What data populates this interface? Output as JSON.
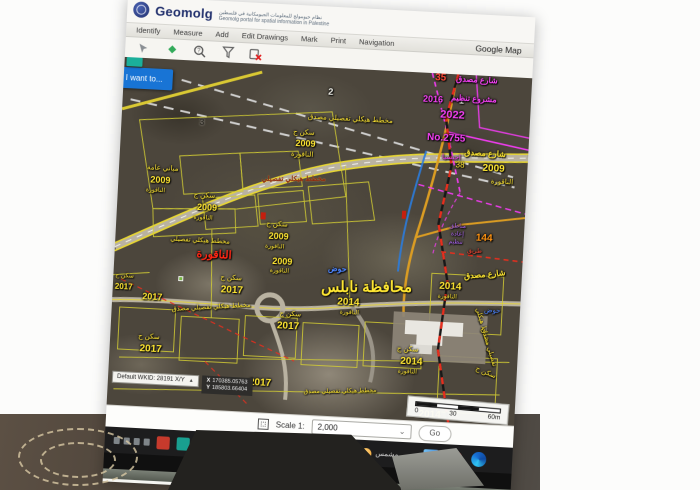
{
  "app": {
    "title": "Geomolg",
    "subtitle_ar": "نظام جيومولج للمعلومات الجيومكانية في فلسطين",
    "subtitle_en": "Geomolg portal for spatial information in Palestine"
  },
  "menu": {
    "items": [
      {
        "id": "identify",
        "label": "Identify"
      },
      {
        "id": "measure",
        "label": "Measure"
      },
      {
        "id": "add",
        "label": "Add"
      },
      {
        "id": "edit-drawings",
        "label": "Edit Drawings"
      },
      {
        "id": "mark",
        "label": "Mark"
      },
      {
        "id": "print",
        "label": "Print"
      },
      {
        "id": "navigation",
        "label": "Navigation"
      },
      {
        "id": "google-map",
        "label": "Google Map",
        "push": true
      }
    ]
  },
  "toolbar": {
    "icons": [
      "pointer-icon",
      "measure-area-icon",
      "identify-question-icon",
      "filter-funnel-icon",
      "clear-graphics-icon"
    ]
  },
  "map": {
    "i_want_to": "I want to...",
    "labels": [
      {
        "t": "2",
        "x": 205,
        "y": 20,
        "c": "wh",
        "s": 9,
        "b": 1
      },
      {
        "t": "1",
        "x": 336,
        "y": 22,
        "c": "wh",
        "s": 9,
        "b": 1
      },
      {
        "t": "3",
        "x": 78,
        "y": 57,
        "c": "dk",
        "s": 9,
        "b": 1
      },
      {
        "t": "35",
        "x": 311,
        "y": 0,
        "c": "rd",
        "s": 10,
        "b": 1
      },
      {
        "t": "شارع مصدق",
        "x": 332,
        "y": 1,
        "c": "m",
        "s": 8,
        "b": 1
      },
      {
        "t": "2016",
        "x": 300,
        "y": 22,
        "c": "m",
        "s": 9,
        "b": 1
      },
      {
        "t": "مشروع تنظيم",
        "x": 328,
        "y": 20,
        "c": "m",
        "s": 8,
        "b": 1
      },
      {
        "t": "2022",
        "x": 318,
        "y": 36,
        "c": "m",
        "s": 11,
        "b": 1
      },
      {
        "t": "No.2755",
        "x": 306,
        "y": 60,
        "c": "m",
        "s": 10,
        "b": 1
      },
      {
        "t": "اجنسيا",
        "x": 322,
        "y": 80,
        "c": "m",
        "s": 7
      },
      {
        "t": "شارع مصدق",
        "x": 344,
        "y": 74,
        "c": "y",
        "s": 8,
        "b": 1
      },
      {
        "t": "38",
        "x": 336,
        "y": 87,
        "c": "y",
        "s": 8
      },
      {
        "t": "2009",
        "x": 363,
        "y": 88,
        "c": "y",
        "s": 10,
        "b": 1
      },
      {
        "t": "الناقورة",
        "x": 372,
        "y": 102,
        "c": "y",
        "s": 7
      },
      {
        "t": "مخطط هيكلي تفصيلي مصدق",
        "x": 186,
        "y": 47,
        "c": "y",
        "s": 7
      },
      {
        "t": "سكن ج",
        "x": 172,
        "y": 63,
        "c": "y",
        "s": 7
      },
      {
        "t": "2009",
        "x": 175,
        "y": 73,
        "c": "y",
        "s": 9,
        "b": 1
      },
      {
        "t": "الناقورة",
        "x": 171,
        "y": 85,
        "c": "y",
        "s": 7
      },
      {
        "t": "مخطط هيكلي تفصيلي",
        "x": 143,
        "y": 110,
        "c": "dr",
        "s": 7,
        "r": -3,
        "b": 1
      },
      {
        "t": "مباني عامة",
        "x": 28,
        "y": 106,
        "c": "y",
        "s": 7
      },
      {
        "t": "2009",
        "x": 32,
        "y": 117,
        "c": "y",
        "s": 9,
        "b": 1
      },
      {
        "t": "الناقورة",
        "x": 28,
        "y": 129,
        "c": "y",
        "s": 6
      },
      {
        "t": "سكن ج",
        "x": 76,
        "y": 131,
        "c": "y",
        "s": 7
      },
      {
        "t": "2009",
        "x": 80,
        "y": 142,
        "c": "y",
        "s": 9,
        "b": 1
      },
      {
        "t": "الناقورة",
        "x": 77,
        "y": 154,
        "c": "y",
        "s": 6
      },
      {
        "t": "مخطط هيكلي تفصيلي",
        "x": 55,
        "y": 177,
        "c": "y",
        "s": 6.5
      },
      {
        "t": "الناقورة",
        "x": 82,
        "y": 188,
        "c": "rd2",
        "s": 11,
        "b": 1
      },
      {
        "t": "سكن ج",
        "x": 150,
        "y": 156,
        "c": "y",
        "s": 7
      },
      {
        "t": "2009",
        "x": 153,
        "y": 167,
        "c": "y",
        "s": 9,
        "b": 1
      },
      {
        "t": "الناقورة",
        "x": 150,
        "y": 179,
        "c": "y",
        "s": 6
      },
      {
        "t": "2009",
        "x": 158,
        "y": 192,
        "c": "y",
        "s": 9,
        "b": 1
      },
      {
        "t": "الناقورة",
        "x": 156,
        "y": 203,
        "c": "y",
        "s": 6
      },
      {
        "t": "مخطط هيكلي تفصيلي مصدق",
        "x": 60,
        "y": 243,
        "c": "y",
        "s": 6.5,
        "r": -6
      },
      {
        "t": "سكن ج",
        "x": 107,
        "y": 212,
        "c": "y",
        "s": 7
      },
      {
        "t": "2017",
        "x": 108,
        "y": 223,
        "c": "y",
        "s": 10,
        "b": 1
      },
      {
        "t": "2017",
        "x": 30,
        "y": 234,
        "c": "y",
        "s": 9,
        "b": 1
      },
      {
        "t": "سكن ج",
        "x": 2,
        "y": 216,
        "c": "y",
        "s": 6
      },
      {
        "t": "2017",
        "x": 2,
        "y": 226,
        "c": "y",
        "s": 8,
        "b": 1
      },
      {
        "t": "سكن ج",
        "x": 168,
        "y": 245,
        "c": "y",
        "s": 7
      },
      {
        "t": "2017",
        "x": 166,
        "y": 256,
        "c": "y",
        "s": 10,
        "b": 1
      },
      {
        "t": "سكن ج",
        "x": 28,
        "y": 275,
        "c": "y",
        "s": 7
      },
      {
        "t": "2017",
        "x": 30,
        "y": 286,
        "c": "y",
        "s": 10,
        "b": 1
      },
      {
        "t": "2017",
        "x": 141,
        "y": 314,
        "c": "y",
        "s": 10,
        "b": 1
      },
      {
        "t": "مخطط هيكلي تفصيلي مصدق",
        "x": 196,
        "y": 320,
        "c": "y",
        "s": 6,
        "r": -4
      },
      {
        "t": "حوض",
        "x": 214,
        "y": 197,
        "c": "bl",
        "s": 8,
        "b": 1
      },
      {
        "t": "محافظة نابلس",
        "x": 208,
        "y": 210,
        "c": "y",
        "s": 15,
        "b": 1,
        "r": -3
      },
      {
        "t": "2014",
        "x": 225,
        "y": 229,
        "c": "y",
        "s": 10,
        "b": 1
      },
      {
        "t": "الناقورة",
        "x": 228,
        "y": 241,
        "c": "y",
        "s": 6
      },
      {
        "t": "سكن ج",
        "x": 287,
        "y": 274,
        "c": "y",
        "s": 7
      },
      {
        "t": "2014",
        "x": 291,
        "y": 285,
        "c": "y",
        "s": 10,
        "b": 1
      },
      {
        "t": "الناقورة",
        "x": 289,
        "y": 297,
        "c": "y",
        "s": 6
      },
      {
        "t": "144",
        "x": 360,
        "y": 158,
        "c": "or",
        "s": 10,
        "b": 1
      },
      {
        "t": "مناطق",
        "x": 333,
        "y": 149,
        "c": "pu",
        "s": 6
      },
      {
        "t": "إعادة",
        "x": 335,
        "y": 157,
        "c": "pu",
        "s": 6
      },
      {
        "t": "تنظيم",
        "x": 333,
        "y": 165,
        "c": "pu",
        "s": 6
      },
      {
        "t": "طريق",
        "x": 352,
        "y": 173,
        "c": "rd",
        "s": 6
      },
      {
        "t": "شارع مصدق",
        "x": 350,
        "y": 195,
        "c": "y",
        "s": 8,
        "b": 1,
        "r": -8
      },
      {
        "t": "2014",
        "x": 326,
        "y": 208,
        "c": "y",
        "s": 10,
        "b": 1
      },
      {
        "t": "الناقورة",
        "x": 325,
        "y": 220,
        "c": "y",
        "s": 6
      },
      {
        "t": "حوض",
        "x": 372,
        "y": 231,
        "c": "bl",
        "s": 7
      },
      {
        "t": "مخطط هيكلي",
        "x": 352,
        "y": 247,
        "c": "y",
        "s": 6.5,
        "r": 70
      },
      {
        "t": "تفصيلي مصدق",
        "x": 358,
        "y": 268,
        "c": "y",
        "s": 6.5,
        "r": 70
      },
      {
        "t": "سكن ج",
        "x": 366,
        "y": 293,
        "c": "y",
        "s": 7,
        "r": 20
      },
      {
        "t": "2014",
        "x": 312,
        "y": 337,
        "c": "y",
        "s": 10,
        "b": 1
      },
      {
        "t": "الناقورة",
        "x": 330,
        "y": 350,
        "c": "y",
        "s": 7,
        "r": 10
      },
      {
        "t": "مخطط هيكلي تفصيلي مصدق",
        "x": 290,
        "y": 362,
        "c": "y",
        "s": 6.5,
        "r": 14
      }
    ]
  },
  "statusbar": {
    "wkid_label": "Default WKID: 28191 X/Y",
    "wkid_caret": "▲",
    "x_label": "X",
    "x_value": "170385.05763",
    "y_label": "Y",
    "y_value": "185803.66404"
  },
  "scale_control": {
    "label": "Scale 1:",
    "value": "2,000",
    "caret": "⌄",
    "go_label": "Go"
  },
  "scalebar": {
    "ticks": [
      "0",
      "30",
      "60m"
    ]
  },
  "taskbar": {
    "tray_icons": [
      {
        "name": "network-icon"
      },
      {
        "name": "volume-icon"
      },
      {
        "name": "battery-icon"
      },
      {
        "name": "language-icon"
      }
    ],
    "app_icons": [
      {
        "name": "red-app-icon",
        "color": "#c23b2e"
      },
      {
        "name": "teal-app-icon",
        "color": "#1d9e8f"
      },
      {
        "name": "green-sheet-icon-1",
        "color": "#1e7b34"
      },
      {
        "name": "green-sheet-icon-2",
        "color": "#227a3a"
      },
      {
        "name": "white-app-icon",
        "color": "#e8e8e6"
      },
      {
        "name": "green-app-icon",
        "color": "#3a7d2c"
      },
      {
        "name": "yellow-app-icon",
        "color": "#d8a020"
      },
      {
        "name": "gray-app-icon",
        "color": "#787878"
      },
      {
        "name": "gear-icon",
        "glyph": "⚙",
        "color": "#c0c0c0"
      },
      {
        "name": "chevron-up-icon",
        "glyph": "^",
        "color": "#dddddd"
      }
    ],
    "weather": {
      "label": "مشمس",
      "icon": "sun-icon",
      "color": "#f2a12f"
    },
    "right_icons": [
      {
        "name": "photos-icon",
        "cls": "photos-icon"
      },
      {
        "name": "chrome-icon",
        "cls": "chrome-icon"
      },
      {
        "name": "edge-icon",
        "cls": "edge-icon"
      }
    ]
  },
  "colors": {
    "accent_blue": "#1b74d1",
    "parcel_yellow": "#d4cf3a",
    "label_yellow": "#ffe73a",
    "plan_magenta": "#f043f0",
    "boundary_red": "#e03020"
  }
}
